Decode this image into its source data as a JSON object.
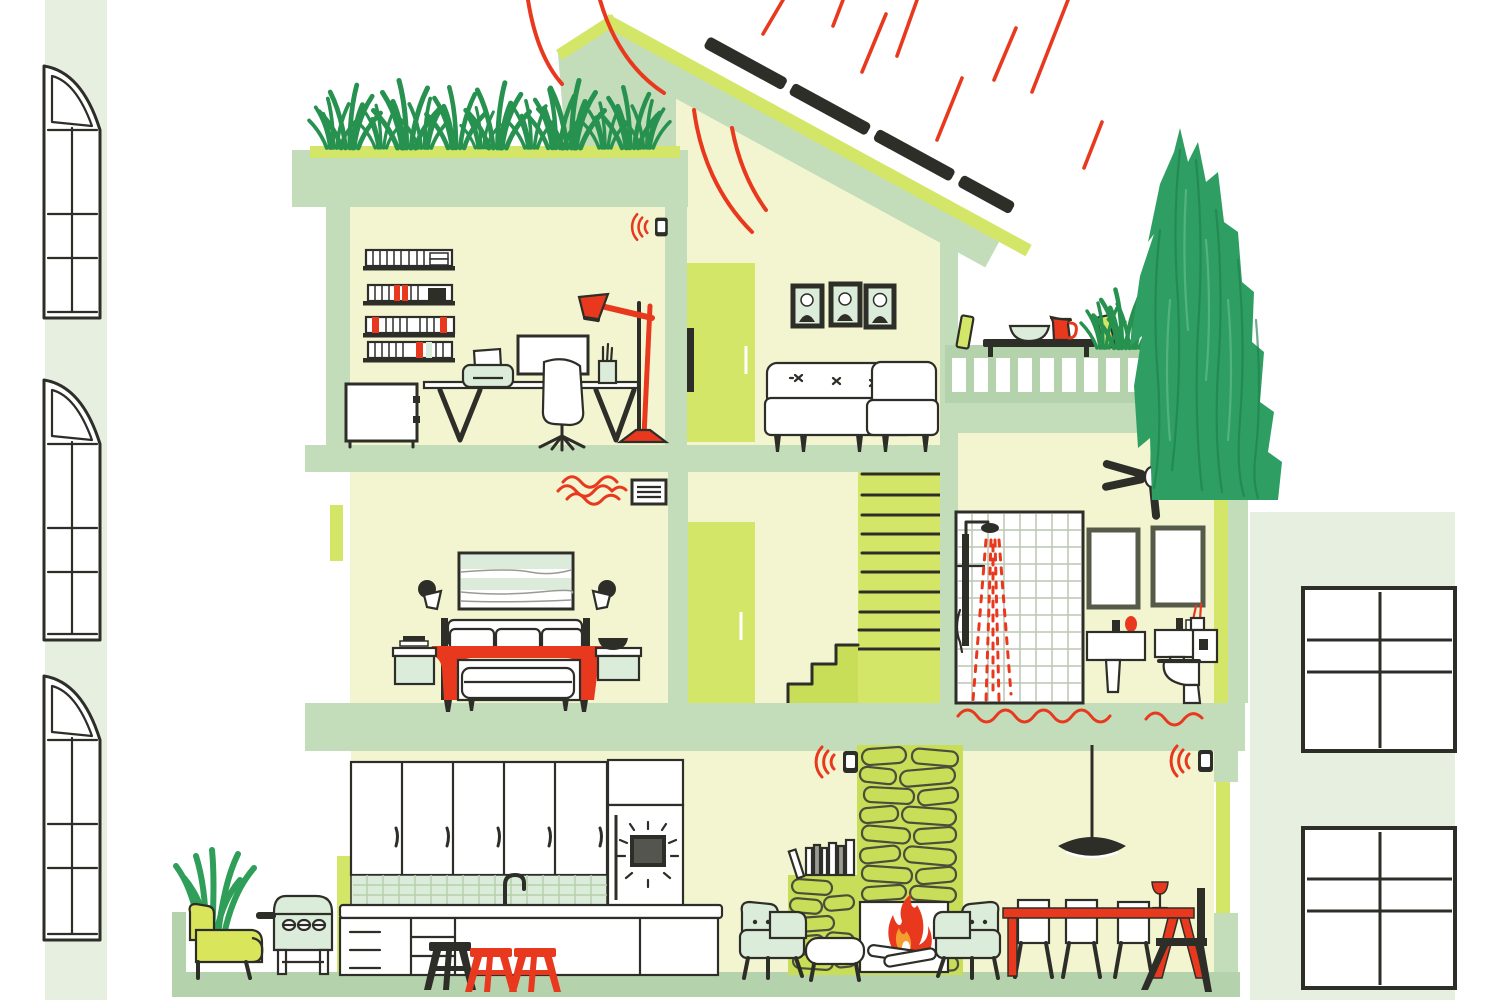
{
  "colors": {
    "paper": "#ffffff",
    "cream": "#f3f5d1",
    "cream2": "#eef2c9",
    "sage": "#c3dcba",
    "sage2": "#b4d2ab",
    "pale_wall": "#e7efe1",
    "chartreuse": "#d4e668",
    "chartreuse_deep": "#c9de58",
    "mint": "#dcecdb",
    "ink": "#2e2e29",
    "red": "#e8391f",
    "orange": "#f59d31",
    "grass": "#27914f",
    "tree": "#2f9e62",
    "tree_dark": "#1d7f4b",
    "tree_light": "#5cb888",
    "grey": "#9a9a92",
    "tile": "#bcc7b2",
    "stone": "#4a4f3a"
  },
  "scene": {
    "type": "cutaway-eco-smart-house-illustration",
    "sky": {
      "sun_ray_count": 8,
      "heat_deflection_arcs": 2
    },
    "roof": {
      "solar_panel_segments": 4,
      "green_roof": true,
      "grass_tuft_rows": 14
    },
    "smart_devices": [
      {
        "name": "smart-thermostat",
        "location": "home-office-ceiling",
        "signal": "wifi"
      },
      {
        "name": "smart-thermostat",
        "location": "chimney-top",
        "signal": "wifi"
      },
      {
        "name": "smart-thermostat",
        "location": "dining-wall",
        "signal": "wifi"
      }
    ],
    "neighbor_buildings": {
      "left_arched_windows": 3,
      "right_grid_windows": 2
    },
    "floors": [
      {
        "name": "top",
        "rooms": [
          "home-office",
          "hallway-door",
          "living-room",
          "roof-terrace"
        ]
      },
      {
        "name": "middle",
        "rooms": [
          "bedroom",
          "stairwell",
          "bathroom"
        ]
      },
      {
        "name": "ground",
        "rooms": [
          "patio",
          "kitchen",
          "fireplace-lounge",
          "dining-area"
        ]
      }
    ],
    "office_items": [
      "bookshelves",
      "file-cabinet",
      "desk",
      "printer",
      "monitor",
      "task-chair",
      "pen-cup",
      "red-floor-lamp"
    ],
    "living_room_items": [
      "three-portrait-frames",
      "sofa",
      "armchair"
    ],
    "terrace_items": [
      "table",
      "bowl",
      "red-pitcher",
      "leaning-panels",
      "grasses",
      "large-tree"
    ],
    "bedroom_items": [
      "landscape-art",
      "two-sconces",
      "bed-with-red-blanket",
      "nightstands",
      "bench",
      "heat-vent"
    ],
    "bathroom_items": [
      "ceiling-fan",
      "tiled-shower",
      "two-mirrors",
      "two-sinks",
      "toilet",
      "radiant-floor-wave"
    ],
    "kitchen_items": [
      "upper-cabinets",
      "tile-backsplash",
      "faucet",
      "island",
      "drawer-unit",
      "black-stool",
      "two-red-stools",
      "smart-fridge"
    ],
    "lounge_items": [
      "stone-chimney",
      "fireplace-fire",
      "mantel-books",
      "two-armchairs",
      "ottoman",
      "pendant-lamp"
    ],
    "dining_items": [
      "red-table",
      "three-white-chairs",
      "black-end-chair",
      "wine-glass"
    ],
    "exterior_items": [
      "yellow-chair",
      "aloe-plant",
      "grill"
    ]
  }
}
